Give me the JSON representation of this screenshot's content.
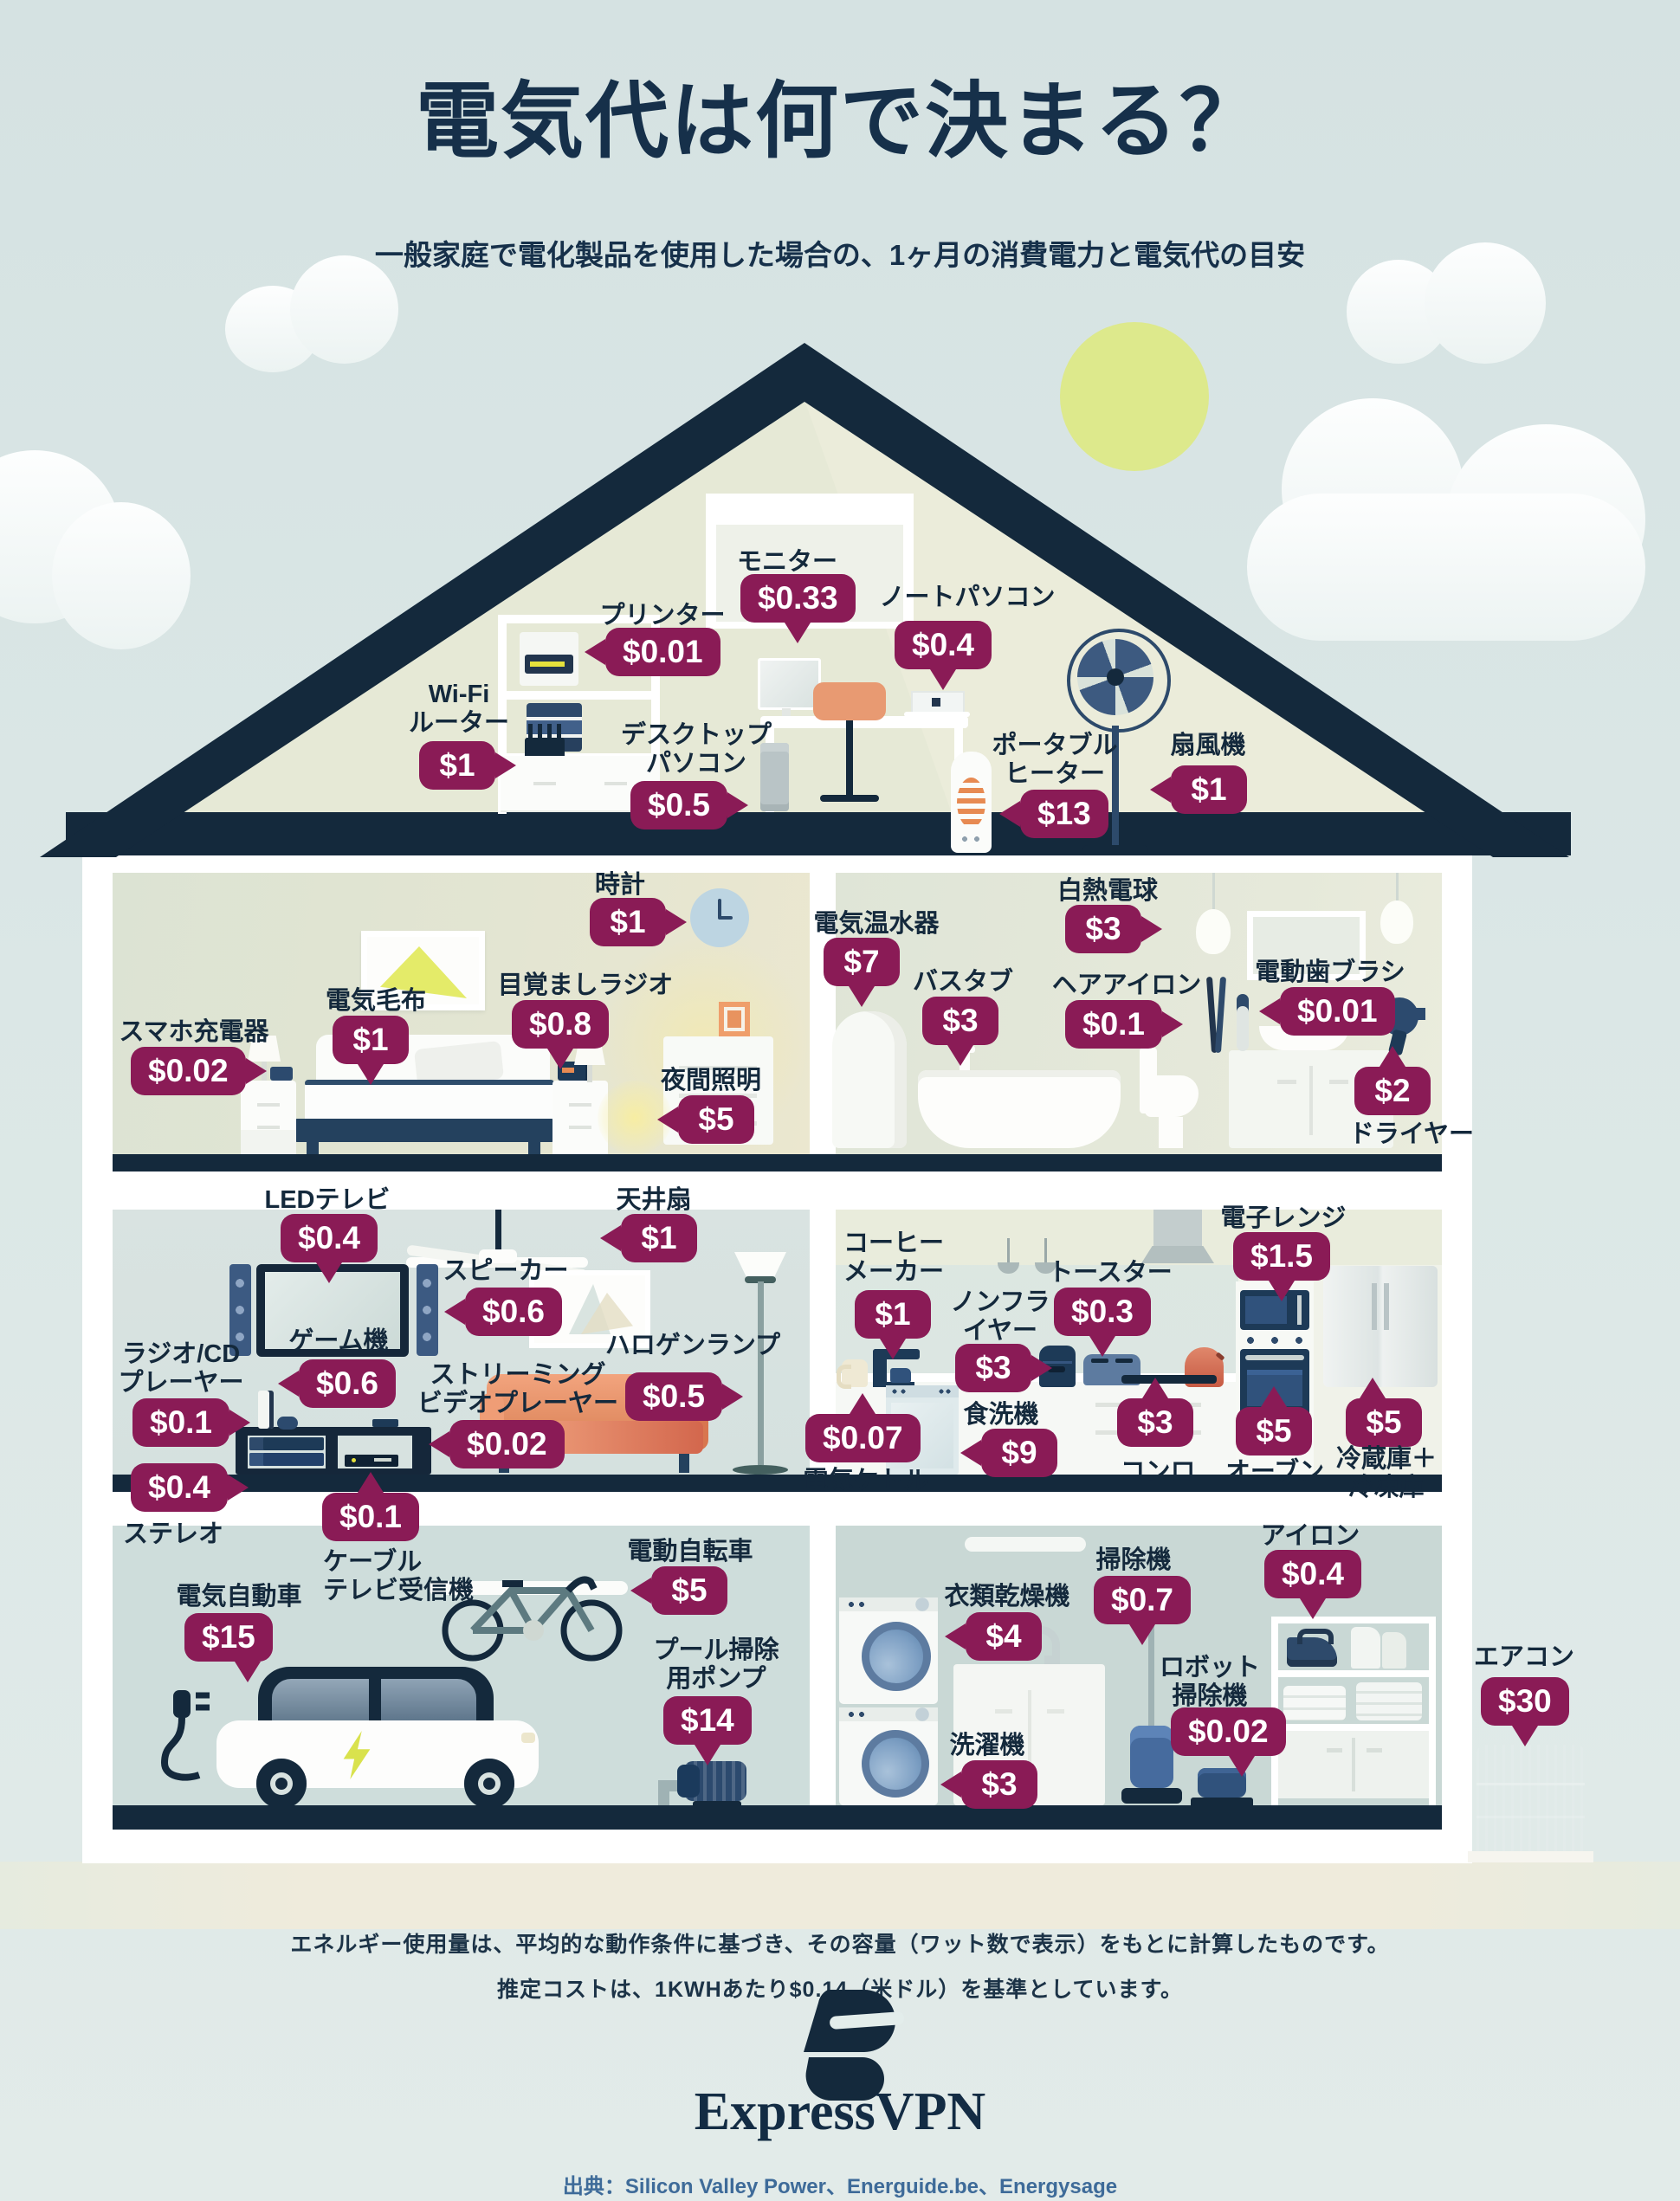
{
  "title": "電気代は何で決まる？",
  "subtitle": "一般家庭で電化製品を使用した場合の、1ヶ月の消費電力と電気代の目安",
  "notes": {
    "line1": "エネルギー使用量は、平均的な動作条件に基づき、その容量（ワット数で表示）をもとに計算したものです。",
    "line2": "推定コストは、1KWHあたり$0.14（米ドル）を基準としています。"
  },
  "brand": {
    "name": "ExpressVPN"
  },
  "source": "出典：Silicon Valley Power、Energuide.be、Energysage",
  "colors": {
    "badge": "#8a1b56",
    "navy": "#14293c",
    "sun": "#dde98c",
    "accent_yellow": "#d9e24d",
    "sky": "#d5e2e2"
  },
  "rooms": {
    "attic": {
      "items": {
        "monitor": {
          "label": "モニター",
          "price": "$0.33"
        },
        "printer": {
          "label": "プリンター",
          "price": "$0.01"
        },
        "laptop": {
          "label": "ノートパソコン",
          "price": "$0.4"
        },
        "wifi_router": {
          "label": "Wi-Fi\nルーター",
          "price": "$1"
        },
        "desktop_pc": {
          "label": "デスクトップ\nパソコン",
          "price": "$0.5"
        },
        "portable_heater": {
          "label": "ポータブル\nヒーター",
          "price": "$13"
        },
        "electric_fan": {
          "label": "扇風機",
          "price": "$1"
        }
      }
    },
    "bedroom": {
      "items": {
        "clock": {
          "label": "時計",
          "price": "$1"
        },
        "electric_blanket": {
          "label": "電気毛布",
          "price": "$1"
        },
        "alarm_radio": {
          "label": "目覚ましラジオ",
          "price": "$0.8"
        },
        "phone_charger": {
          "label": "スマホ充電器",
          "price": "$0.02"
        },
        "night_light": {
          "label": "夜間照明",
          "price": "$5"
        }
      }
    },
    "bathroom": {
      "items": {
        "water_heater": {
          "label": "電気温水器",
          "price": "$7"
        },
        "incandescent_bulb": {
          "label": "白熱電球",
          "price": "$3"
        },
        "bathtub": {
          "label": "バスタブ",
          "price": "$3"
        },
        "hair_iron": {
          "label": "ヘアアイロン",
          "price": "$0.1"
        },
        "electric_toothbrush": {
          "label": "電動歯ブラシ",
          "price": "$0.01"
        },
        "hair_dryer": {
          "label": "ドライヤー",
          "price": "$2"
        }
      }
    },
    "living_room": {
      "items": {
        "led_tv": {
          "label": "LEDテレビ",
          "price": "$0.4"
        },
        "ceiling_fan": {
          "label": "天井扇",
          "price": "$1"
        },
        "speaker": {
          "label": "スピーカー",
          "price": "$0.6"
        },
        "game_console": {
          "label": "ゲーム機",
          "price": "$0.6"
        },
        "radio_cd_player": {
          "label": "ラジオ/CD\nプレーヤー",
          "price": "$0.1"
        },
        "stereo": {
          "label": "ステレオ",
          "price": "$0.4"
        },
        "streaming_player": {
          "label": "ストリーミング\nビデオプレーヤー",
          "price": "$0.02"
        },
        "halogen_lamp": {
          "label": "ハロゲンランプ",
          "price": "$0.5"
        },
        "cable_tv_receiver": {
          "label": "ケーブル\nテレビ受信機",
          "price": "$0.1"
        }
      }
    },
    "kitchen": {
      "items": {
        "coffee_maker": {
          "label": "コーヒー\nメーカー",
          "price": "$1"
        },
        "electric_kettle": {
          "label": "電気ケトル",
          "price": "$0.07"
        },
        "air_fryer": {
          "label": "ノンフラ\nイヤー",
          "price": "$3"
        },
        "toaster": {
          "label": "トースター",
          "price": "$0.3"
        },
        "microwave": {
          "label": "電子レンジ",
          "price": "$1.5"
        },
        "dishwasher": {
          "label": "食洗機",
          "price": "$9"
        },
        "stove": {
          "label": "コンロ",
          "price": "$3"
        },
        "oven": {
          "label": "オーブン",
          "price": "$5"
        },
        "fridge_freezer": {
          "label": "冷蔵庫＋\n冷凍庫",
          "price": "$5"
        }
      }
    },
    "garage": {
      "items": {
        "electric_car": {
          "label": "電気自動車",
          "price": "$15"
        },
        "electric_bike": {
          "label": "電動自転車",
          "price": "$5"
        },
        "pool_pump": {
          "label": "プール掃除\n用ポンプ",
          "price": "$14"
        }
      }
    },
    "laundry": {
      "items": {
        "clothes_dryer": {
          "label": "衣類乾燥機",
          "price": "$4"
        },
        "vacuum": {
          "label": "掃除機",
          "price": "$0.7"
        },
        "iron": {
          "label": "アイロン",
          "price": "$0.4"
        },
        "robot_vacuum": {
          "label": "ロボット\n掃除機",
          "price": "$0.02"
        },
        "washing_machine": {
          "label": "洗濯機",
          "price": "$3"
        }
      }
    },
    "exterior": {
      "items": {
        "air_conditioner": {
          "label": "エアコン",
          "price": "$30"
        }
      }
    }
  }
}
